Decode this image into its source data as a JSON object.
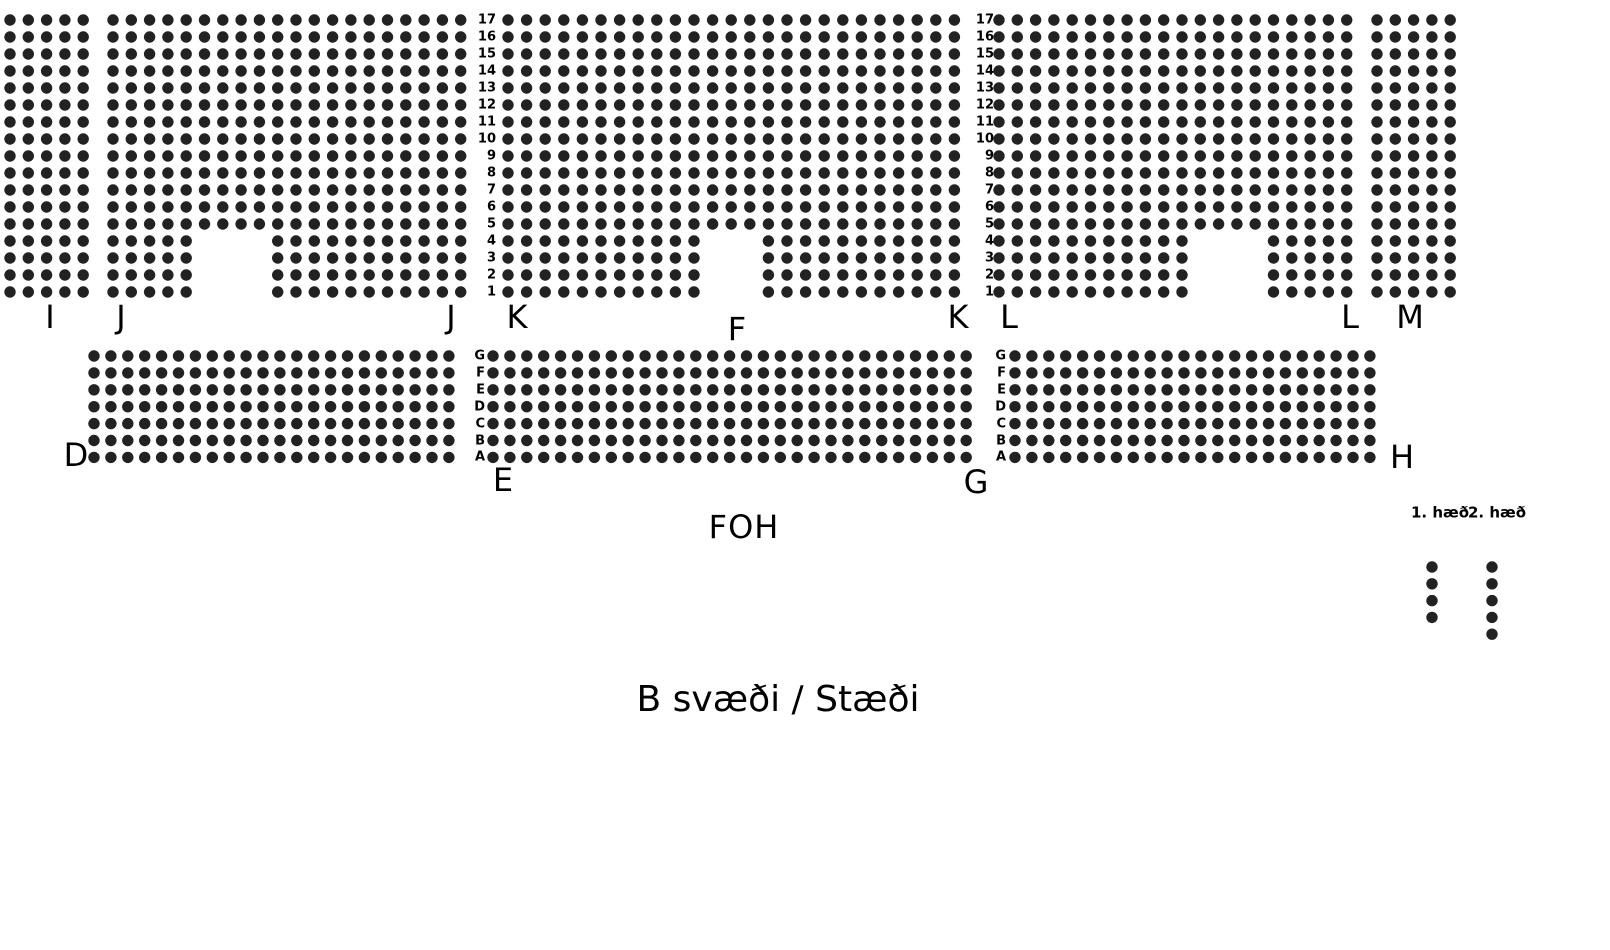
{
  "page": {
    "title": "B svæði / Stæði",
    "foh": "FOH"
  },
  "colors": {
    "seat": "#222222",
    "text": "#000000"
  },
  "top_band": {
    "rows": 17,
    "row_numbers": [
      "17",
      "16",
      "15",
      "14",
      "13",
      "12",
      "11",
      "10",
      "9",
      "8",
      "7",
      "6",
      "5",
      "4",
      "3",
      "2",
      "1"
    ],
    "number_columns_right_x": [
      496,
      994
    ],
    "sections": [
      {
        "name": "I",
        "x": 10,
        "cols": 5,
        "notch": null
      },
      {
        "name": "J",
        "x": 113,
        "cols": 20,
        "notch": {
          "bottom_rows": 4,
          "from_col": 5,
          "to_col": 8
        }
      },
      {
        "name": "K",
        "x": 508,
        "cols": 25,
        "dx": 18.6,
        "notch": {
          "bottom_rows": 4,
          "from_col": 11,
          "to_col": 13
        }
      },
      {
        "name": "L",
        "x": 999,
        "cols": 20,
        "notch": {
          "bottom_rows": 4,
          "from_col": 11,
          "to_col": 14
        }
      },
      {
        "name": "M",
        "x": 1377,
        "cols": 5,
        "notch": null
      }
    ]
  },
  "middle_band": {
    "rows": 7,
    "row_letters": [
      "G",
      "F",
      "E",
      "D",
      "C",
      "B",
      "A"
    ],
    "letter_columns_right_x": [
      485,
      1006
    ],
    "sections": [
      {
        "name": "D",
        "x": 94,
        "cols": 22
      },
      {
        "name": "EF",
        "x": 493,
        "cols": 29
      },
      {
        "name": "GH",
        "x": 1015,
        "cols": 22
      }
    ]
  },
  "section_labels": [
    {
      "text": "I",
      "x": 50,
      "y": 317
    },
    {
      "text": "J",
      "x": 121,
      "y": 317
    },
    {
      "text": "J",
      "x": 451,
      "y": 317
    },
    {
      "text": "K",
      "x": 517,
      "y": 317
    },
    {
      "text": "F",
      "x": 737,
      "y": 329
    },
    {
      "text": "K",
      "x": 958,
      "y": 317
    },
    {
      "text": "L",
      "x": 1009,
      "y": 317
    },
    {
      "text": "L",
      "x": 1350,
      "y": 317
    },
    {
      "text": "M",
      "x": 1410,
      "y": 317
    },
    {
      "text": "D",
      "x": 76,
      "y": 455
    },
    {
      "text": "E",
      "x": 503,
      "y": 480
    },
    {
      "text": "G",
      "x": 976,
      "y": 482
    },
    {
      "text": "H",
      "x": 1402,
      "y": 457
    }
  ],
  "legend": {
    "labels": [
      {
        "text": "1. hæð",
        "x": 1440
      },
      {
        "text": "2. hæð",
        "x": 1497
      }
    ],
    "label_y": 513,
    "columns": [
      {
        "floor": "1. hæð",
        "x": 1432,
        "dots": 4
      },
      {
        "floor": "2. hæð",
        "x": 1492,
        "dots": 5
      }
    ],
    "dots_start_y": 567,
    "dot_spacing": 16.8
  }
}
